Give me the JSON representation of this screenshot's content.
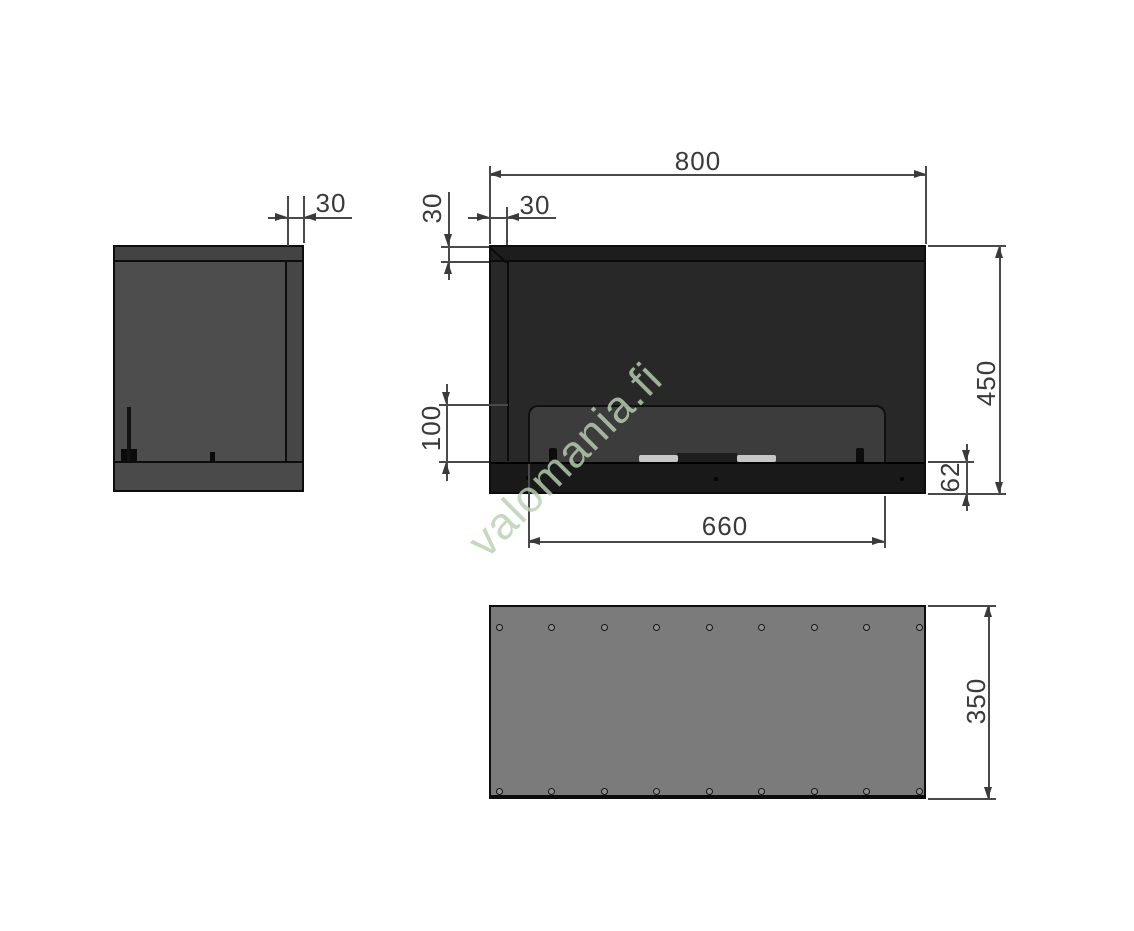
{
  "watermark": {
    "text": "valomania.fi",
    "color": "#b8d0b2"
  },
  "dimensions": {
    "overall_width": "800",
    "overall_height": "450",
    "overall_depth": "350",
    "opening_width": "660",
    "glass_opening_height": "100",
    "base_height": "62",
    "top_frame_height": "30",
    "left_frame_width": "30",
    "front_panel_depth": "30"
  },
  "top_view": {
    "hole_columns": 9,
    "hole_rows": 2
  },
  "style": {
    "line_color": "#3a3a3a",
    "body_dark": "#272727",
    "body_medium": "#4b4b4b",
    "body_light": "#7b7b7b"
  }
}
